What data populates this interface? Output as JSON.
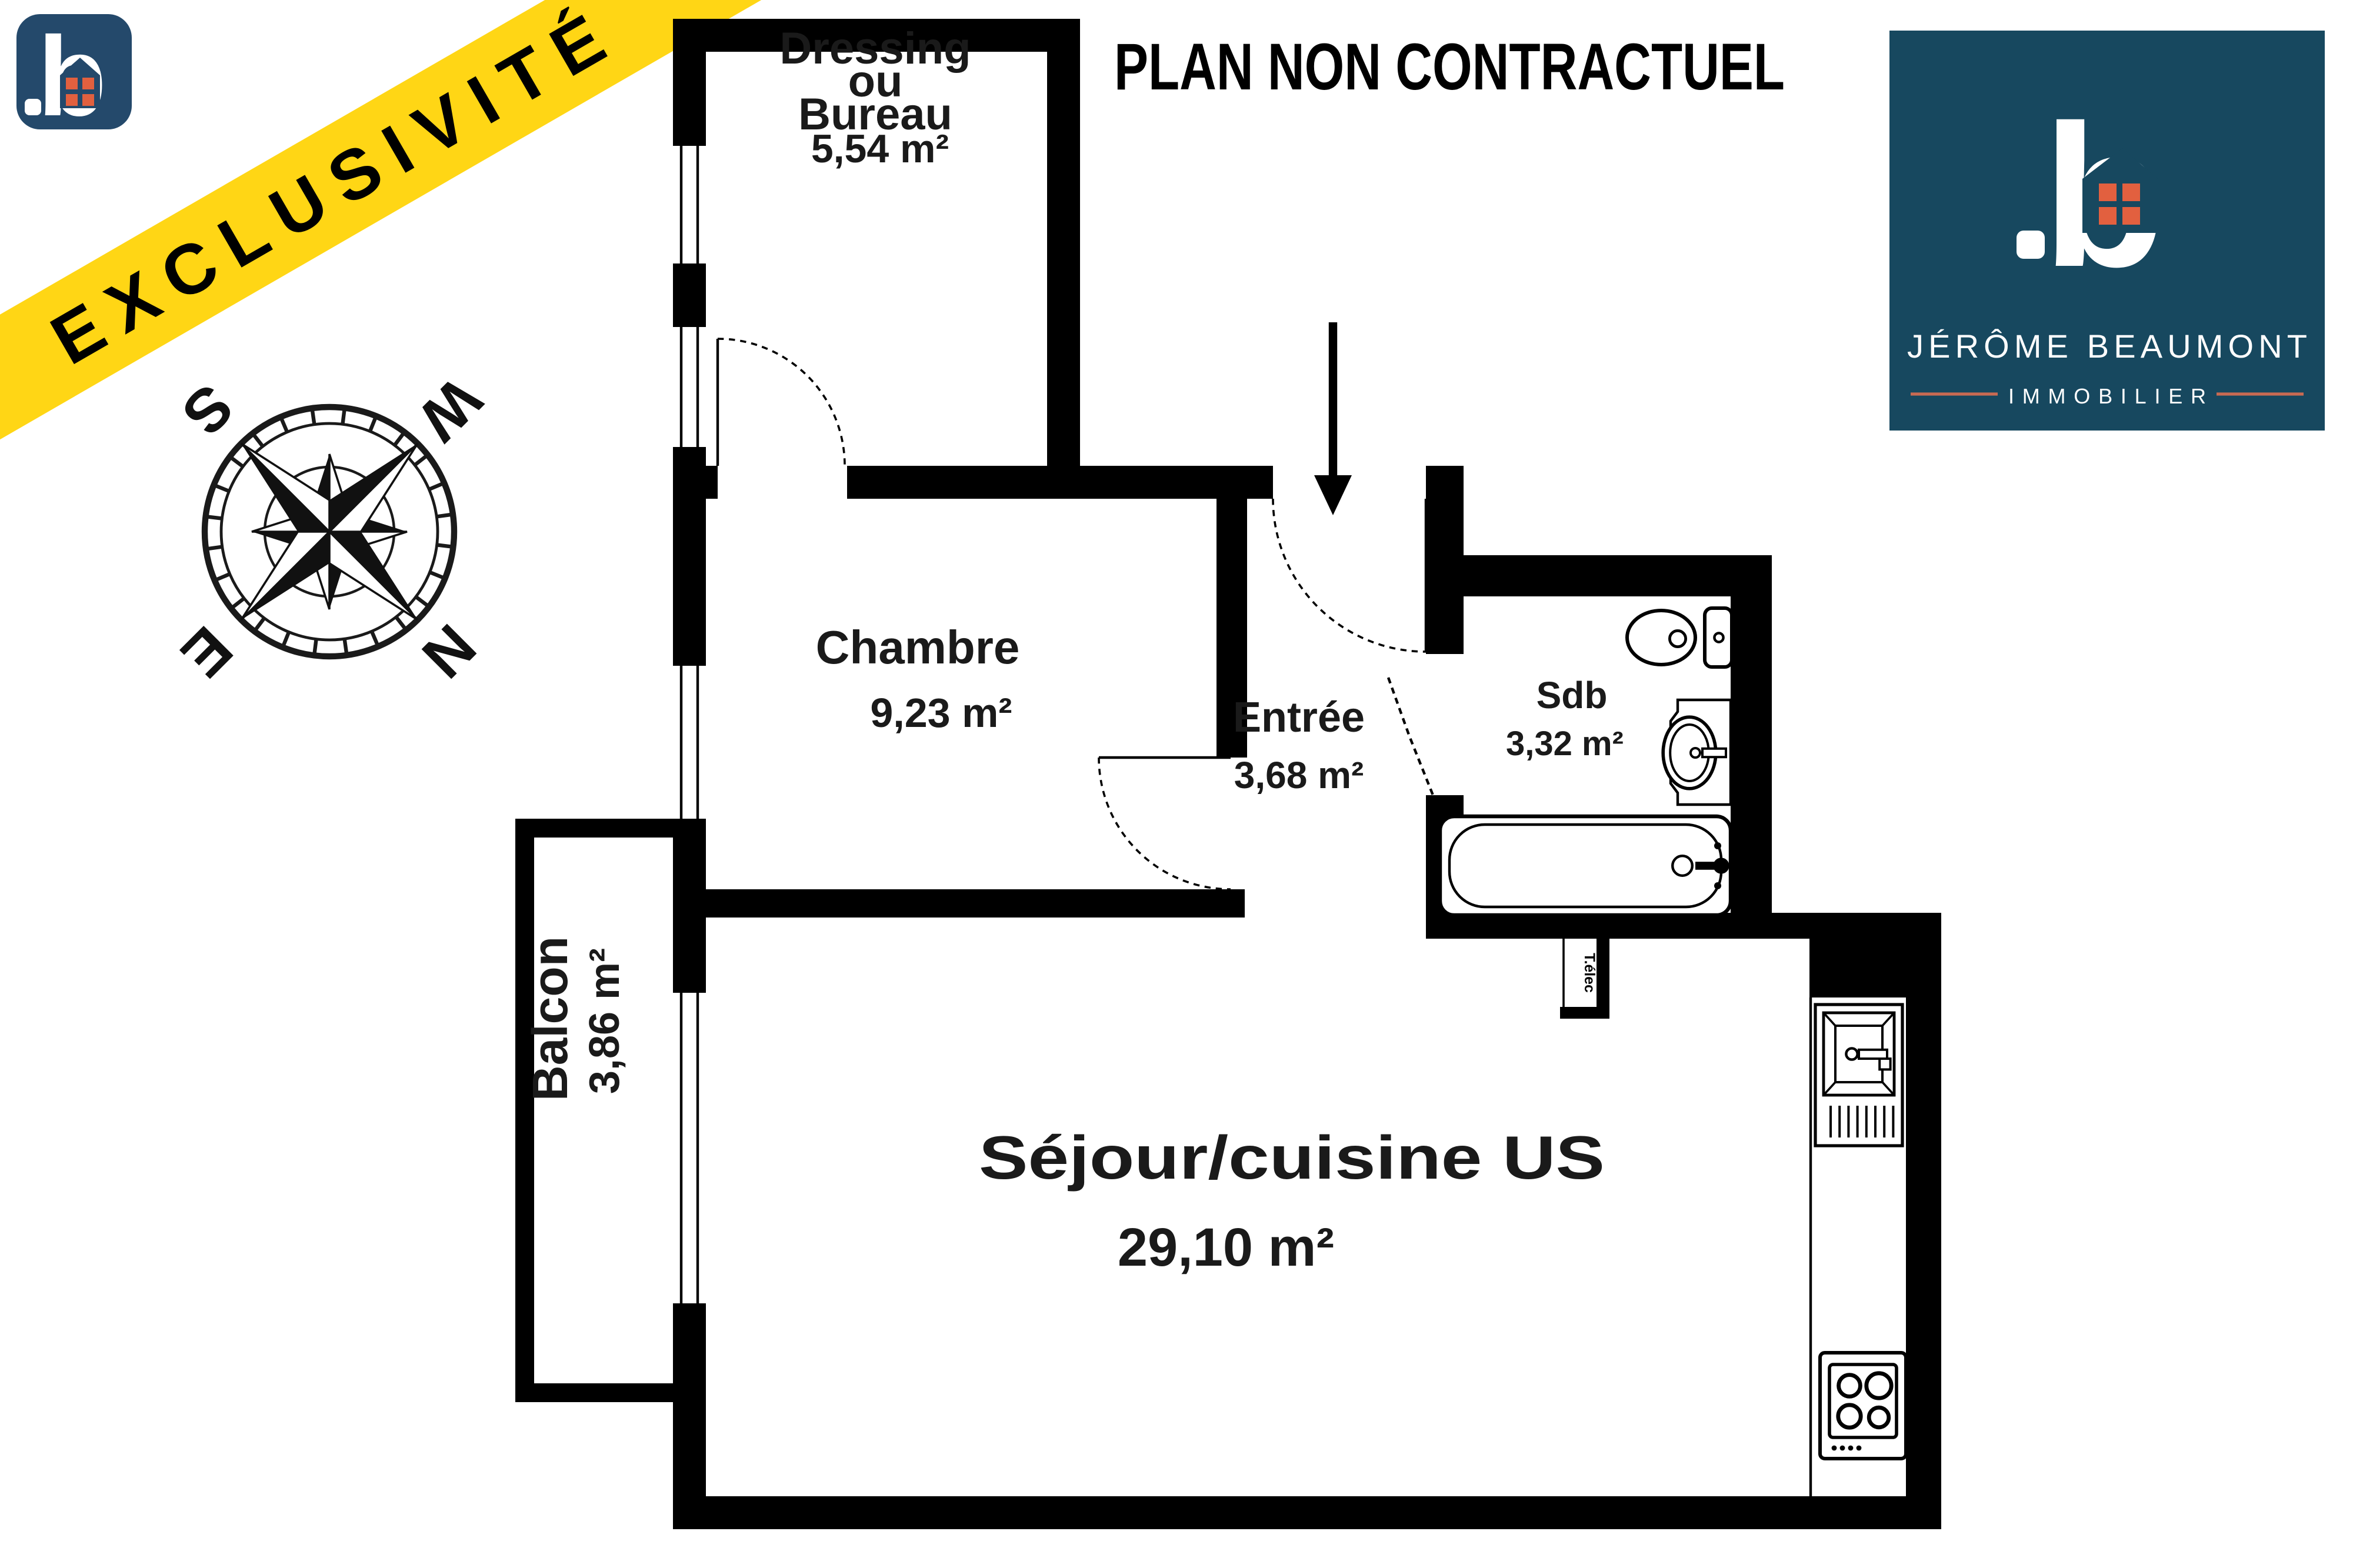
{
  "title": {
    "text": "PLAN NON CONTRACTUEL"
  },
  "banner": {
    "text": "EXCLUSIVITÉ",
    "color": "#ffd615",
    "text_color": "#000000"
  },
  "brand": {
    "monogram": "b",
    "agency_line1": "JÉRÔME BEAUMONT",
    "agency_line2": "IMMOBILIER",
    "panel_color": "#17485f",
    "small_logo_color": "#24496b",
    "accent_color": "#e2603f",
    "divider_color": "#c96a52"
  },
  "compass": {
    "north": "N",
    "east": "E",
    "south": "S",
    "west": "W"
  },
  "rooms": {
    "dressing": {
      "line1": "Dressing",
      "line2": "ou",
      "line3": "Bureau",
      "area": "5,54 m²"
    },
    "chambre": {
      "label": "Chambre",
      "area": "9,23 m²"
    },
    "entree": {
      "label": "Entrée",
      "area": "3,68 m²"
    },
    "sdb": {
      "label": "Sdb",
      "area": "3,32 m²"
    },
    "sejour": {
      "label": "Séjour/cuisine US",
      "area": "29,10 m²"
    },
    "balcon": {
      "label": "Balcon",
      "area": "3,86 m²"
    }
  },
  "fixtures": {
    "electrical_panel": "T.élec"
  },
  "plan": {
    "wall_color": "#000000",
    "floor_color": "#ffffff"
  }
}
